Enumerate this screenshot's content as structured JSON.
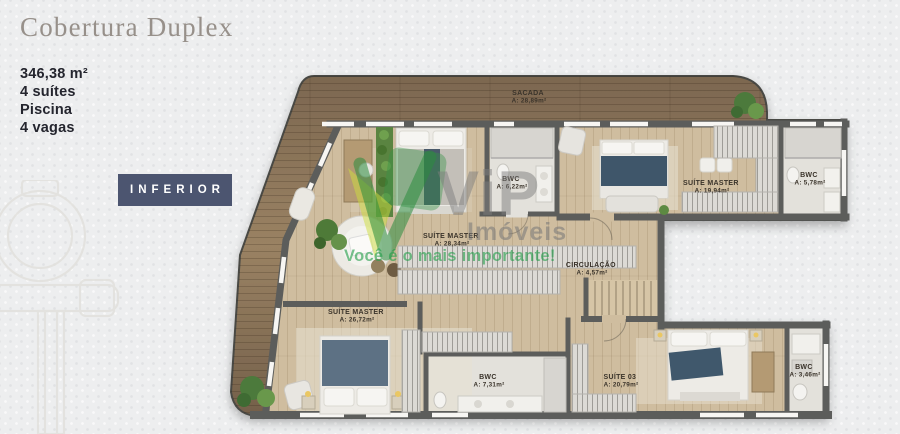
{
  "panel": {
    "title": "Cobertura Duplex",
    "specs": [
      "346,38 m²",
      "4 suítes",
      "Piscina",
      "4 vagas"
    ],
    "floor_button": "INFERIOR"
  },
  "watermark": {
    "brand_top": "ViP",
    "brand_bottom": "Imóveis",
    "slogan": "Você é o mais importante!"
  },
  "plan": {
    "rooms": [
      {
        "name": "SACADA",
        "area": "A: 28,89m²"
      },
      {
        "name": "BWC",
        "area": "A: 6,22m²"
      },
      {
        "name": "SUÍTE MASTER",
        "area": "A: 19,94m²"
      },
      {
        "name": "BWC",
        "area": "A: 5,78m²"
      },
      {
        "name": "SUÍTE MASTER",
        "area": "A: 28,34m²"
      },
      {
        "name": "CIRCULAÇÃO",
        "area": "A: 4,57m²"
      },
      {
        "name": "SUÍTE MASTER",
        "area": "A: 26,72m²"
      },
      {
        "name": "BWC",
        "area": "A: 7,31m²"
      },
      {
        "name": "SUÍTE 03",
        "area": "A: 20,79m²"
      },
      {
        "name": "BWC",
        "area": "A: 3,46m²"
      }
    ],
    "colors": {
      "button_bg": "#4c5570",
      "title_text": "#97908a",
      "spec_text": "#24252e",
      "wall": "#5c5d5b",
      "deck_wood": "#8a7257",
      "floor_wood": "#cfbd9f",
      "bathroom_floor": "#e3e1db",
      "watermark_green": "#2fae4e",
      "watermark_gray": "#7e7e7e"
    }
  }
}
